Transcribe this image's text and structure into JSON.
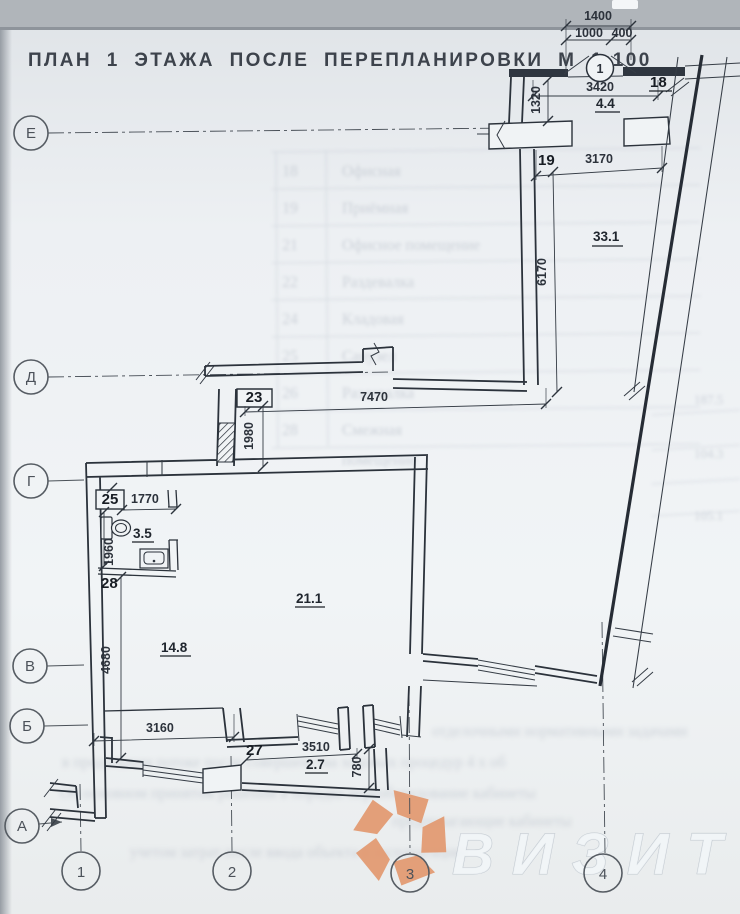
{
  "colors": {
    "paper": "#eef1f3",
    "band": "#b0b5ba",
    "ink": "#2b323b",
    "logo_orange": "#e2986f",
    "watermark_gray": "#eceff2"
  },
  "title": "ПЛАН 1 ЭТАЖА ПОСЛЕ ПЕРЕПЛАНИРОВКИ М 1:100",
  "axes": {
    "rows": [
      "Е",
      "Д",
      "Г",
      "В",
      "Б",
      "А"
    ],
    "cols": [
      "1",
      "2",
      "3",
      "4"
    ]
  },
  "callout": {
    "label": "1"
  },
  "dims": {
    "w1400": "1400",
    "w1000": "1000",
    "w400": "400",
    "w3420": "3420",
    "h1320": "1320",
    "w3170": "3170",
    "h6170": "6170",
    "w7470": "7470",
    "h1980": "1980",
    "w1770": "1770",
    "h1960": "1960",
    "h4680": "4680",
    "w3160": "3160",
    "w3510": "3510",
    "h780": "780"
  },
  "rooms": {
    "n18": "18",
    "a18": "4.4",
    "n19": "19",
    "a33": "33.1",
    "n23": "23",
    "n25": "25",
    "a35": "3.5",
    "n28": "28",
    "a211": "21.1",
    "a148": "14.8",
    "n27": "27",
    "a27": "2.7"
  },
  "watermark": {
    "text": "ВИЗИТ"
  },
  "ghost": {
    "table": [
      {
        "no": "18",
        "name": "Офисная"
      },
      {
        "no": "19",
        "name": "Приёмная"
      },
      {
        "no": "21",
        "name": "Офисное помещение"
      },
      {
        "no": "22",
        "name": "Раздевалка"
      },
      {
        "no": "24",
        "name": "Кладовая"
      },
      {
        "no": "25",
        "name": "Санузел"
      },
      {
        "no": "26",
        "name": "Раздевалка"
      },
      {
        "no": "28",
        "name": "Смежная"
      },
      {
        "no": "",
        "name": "помещение"
      }
    ],
    "right_figures": [
      "187.5",
      "104.3",
      "105.1"
    ],
    "lines": [
      "отделочными нормативными задачами",
      "в продольном потоке после совершенства ходовых процедур 4 х об",
      "Об основном принятом решении в порядке переоборудование кабинеты",
      "предполагающие кабинеты",
      "учетом затрат после ввода объекта в эксплуатацию"
    ]
  }
}
